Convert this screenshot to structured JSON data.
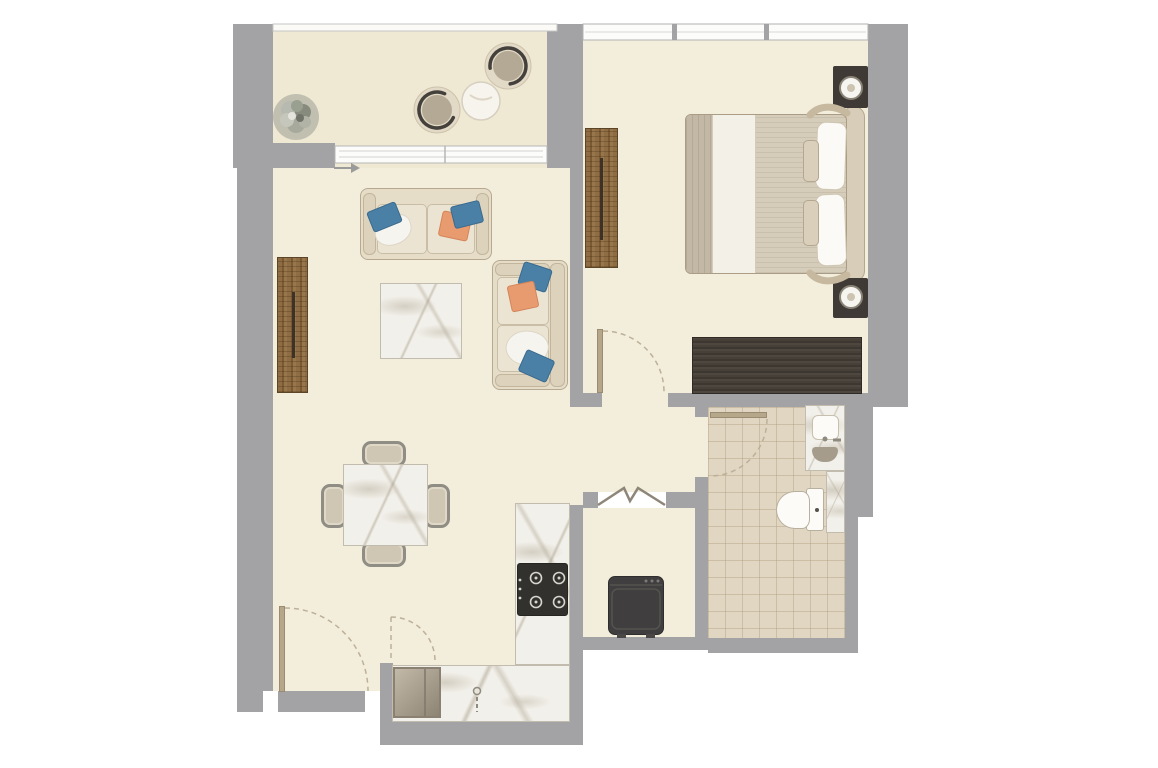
{
  "meta": {
    "title": "Apartment floor plan — top-down architectural rendering",
    "type": "architectural-floor-plan",
    "canvas": {
      "width": 1158,
      "height": 768
    },
    "visible_text": []
  },
  "palette": {
    "wall": "#a3a2a4",
    "floor": "#f3eedc",
    "balconyFloor": "#efe9d4",
    "tile": "#e1d6c1",
    "marble": "#f2f0ea",
    "wood": "#8d6b42",
    "darkWood": "#48413a",
    "sofaFabric": "#e6ddc9",
    "pillowBlue": "#4a80a6",
    "pillowOrange": "#e89b6e",
    "appliance": "#393736",
    "doorLeaf": "#b6a78a",
    "doorArc": "#bdb098",
    "windowFrame": "#b2b2b2",
    "chairRail": "#44403b",
    "plantFoliage": "#9a9d92"
  },
  "rooms": [
    {
      "id": "balcony",
      "label": "Balcony",
      "position": "top-left"
    },
    {
      "id": "living-dining",
      "label": "Living / Dining Room",
      "position": "center-left"
    },
    {
      "id": "bedroom",
      "label": "Bedroom",
      "position": "top-right"
    },
    {
      "id": "kitchen",
      "label": "Kitchen",
      "position": "bottom-center"
    },
    {
      "id": "bathroom",
      "label": "Bathroom",
      "position": "bottom-right"
    },
    {
      "id": "utility",
      "label": "Utility Closet",
      "position": "bottom-center-right"
    },
    {
      "id": "hallway",
      "label": "Hallway",
      "position": "center"
    }
  ],
  "furniture": {
    "balcony": [
      "potted-plant",
      "lounge-chair",
      "lounge-chair",
      "round-side-table"
    ],
    "living_dining": [
      "tv-console",
      "three-seat-sofa",
      "chaise-sofa",
      "coffee-table",
      "dining-table",
      "dining-chair",
      "dining-chair",
      "dining-chair",
      "dining-chair",
      "throw-blanket",
      "throw-blanket",
      "pillow-blue",
      "pillow-blue",
      "pillow-blue",
      "pillow-blue",
      "pillow-orange",
      "pillow-orange"
    ],
    "bedroom": [
      "double-bed",
      "headboard",
      "pillow",
      "pillow",
      "cushion",
      "cushion",
      "nightstand-with-lamp",
      "nightstand-with-lamp",
      "wardrobe",
      "dresser"
    ],
    "kitchen": [
      "l-shaped-marble-counter",
      "cooktop-4-burner",
      "kitchen-sink",
      "faucet"
    ],
    "bathroom": [
      "vanity-counter",
      "vanity-sink",
      "faucet",
      "toilet",
      "bath-mat"
    ],
    "utility": [
      "washing-machine"
    ]
  },
  "openings": {
    "windows": [
      "balcony-railing",
      "balcony-sliding-door",
      "bedroom-triple-window"
    ],
    "doors": [
      "entry-door-swing",
      "inner-entry-door-swing",
      "bedroom-door-swing",
      "bathroom-door-swing",
      "utility-bifold-door"
    ],
    "annotations": [
      "entry-direction-arrow"
    ]
  }
}
